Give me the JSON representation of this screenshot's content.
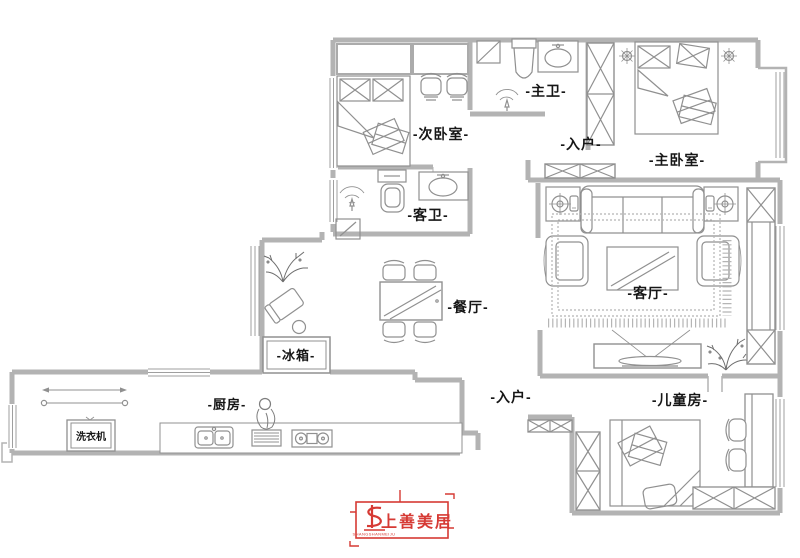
{
  "title": "apartment-floor-plan",
  "colors": {
    "wall": "#b3b3b3",
    "furniture": "#909090",
    "furniture_light": "#ababab",
    "label": "#161616",
    "logo_red": "#d63a34"
  },
  "labels": {
    "secondary_bedroom": "-次卧室-",
    "master_bath": "-主卫-",
    "entry_upper": "-入户-",
    "master_bedroom": "-主卧室-",
    "guest_bath": "-客卫-",
    "dining": "-餐厅-",
    "living": "-客厅-",
    "fridge": "-冰箱-",
    "kitchen": "-厨房-",
    "washing_machine": "洗衣机",
    "entry_lower": "-入户-",
    "kids_room": "-儿童房-"
  },
  "logo": {
    "text": "上善美居",
    "subtext": "SHANGSHANMEIJU"
  }
}
